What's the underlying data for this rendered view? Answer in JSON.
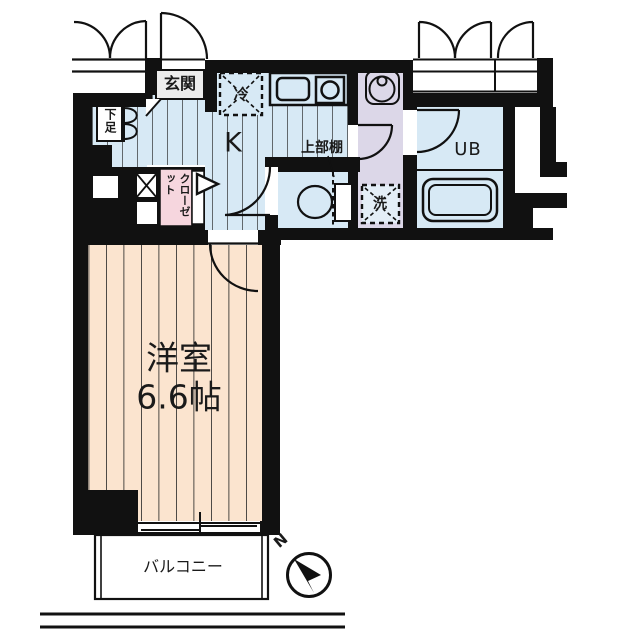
{
  "labels": {
    "entrance": "玄関",
    "shoe_cabinet": "下足",
    "refrigerator": "冷",
    "kitchen": "K",
    "upper_shelf": "上部棚",
    "washer": "洗",
    "unit_bath": "UB",
    "closet": "クローゼット",
    "room_name": "洋室",
    "room_size": "6.6帖",
    "balcony": "バルコニー",
    "compass_north": "N"
  },
  "colors": {
    "wall": "#111111",
    "floor_blue": "#d7e9f5",
    "floor_lavender": "#dcd7e8",
    "floor_peach": "#fbe4cf",
    "closet_pink": "#f6d6de",
    "genkan_gray": "#ececec",
    "stripe": "#222222"
  }
}
